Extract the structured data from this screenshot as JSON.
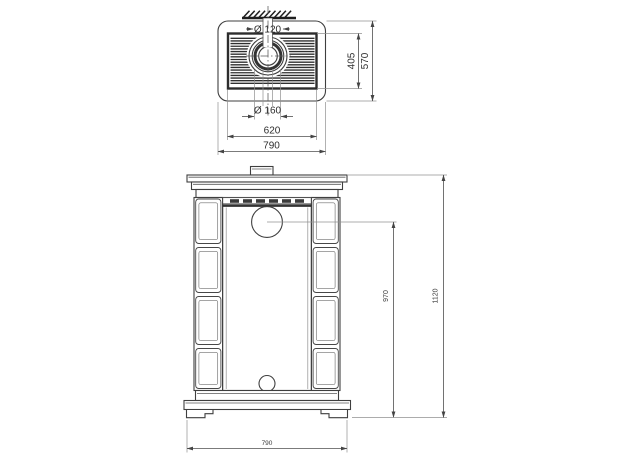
{
  "colors": {
    "line": "#3f3f3f",
    "background": "#ffffff"
  },
  "top_view": {
    "dimensions": {
      "flue_inner_diameter": "Ø 120",
      "flue_collar_diameter": "Ø 160",
      "grille_depth": "405",
      "top_plate_depth": "570",
      "grille_width": "620",
      "top_plate_width": "790"
    }
  },
  "front_view": {
    "dimensions": {
      "flue_center_height": "970",
      "overall_height": "1120",
      "overall_width": "790"
    }
  }
}
